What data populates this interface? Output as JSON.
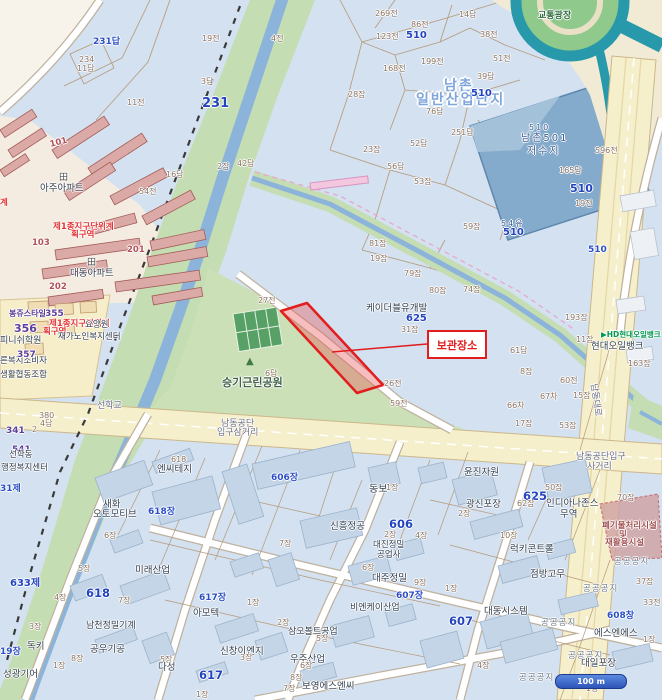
{
  "map": {
    "annotation": {
      "label": "보관장소"
    },
    "scale_bar": {
      "label": "100 m"
    },
    "colors": {
      "parcel_bg": "#d3e1f0",
      "park_green": "#cbe0b6",
      "river_bank": "#c5ddb2",
      "water": "#8cb4da",
      "reservoir": "#85abcc",
      "road_yellow": "#f6efcc",
      "expressway_teal": "#2898ab",
      "highlight_red": "#e21d1d",
      "residential": "#f5ece1",
      "apartment": "#dcaaa6"
    },
    "labels": [
      {
        "t": "231답",
        "x": 93,
        "y": 38,
        "c": "b"
      },
      {
        "t": "234",
        "x": 79,
        "y": 56,
        "c": "p"
      },
      {
        "t": "11답",
        "x": 77,
        "y": 65,
        "c": "p"
      },
      {
        "t": "19전",
        "x": 202,
        "y": 35,
        "c": "p"
      },
      {
        "t": "3답",
        "x": 201,
        "y": 78,
        "c": "p"
      },
      {
        "t": "231",
        "x": 202,
        "y": 97,
        "c": "B",
        "fs": 13
      },
      {
        "t": "11전",
        "x": 127,
        "y": 99,
        "c": "p"
      },
      {
        "t": "4전",
        "x": 271,
        "y": 35,
        "c": "p"
      },
      {
        "t": "42답",
        "x": 237,
        "y": 160,
        "c": "p"
      },
      {
        "t": "16답",
        "x": 166,
        "y": 171,
        "c": "p"
      },
      {
        "t": "54전",
        "x": 139,
        "y": 188,
        "c": "p"
      },
      {
        "t": "2잡",
        "x": 217,
        "y": 163,
        "c": "p"
      },
      {
        "t": "269전",
        "x": 375,
        "y": 10,
        "c": "p"
      },
      {
        "t": "86전",
        "x": 411,
        "y": 21,
        "c": "p"
      },
      {
        "t": "123전",
        "x": 376,
        "y": 33,
        "c": "p"
      },
      {
        "t": "510",
        "x": 406,
        "y": 31,
        "c": "B",
        "fs": 10
      },
      {
        "t": "14답",
        "x": 459,
        "y": 11,
        "c": "p"
      },
      {
        "t": "38전",
        "x": 480,
        "y": 31,
        "c": "p"
      },
      {
        "t": "199전",
        "x": 421,
        "y": 58,
        "c": "p"
      },
      {
        "t": "51전",
        "x": 493,
        "y": 55,
        "c": "p"
      },
      {
        "t": "168전",
        "x": 383,
        "y": 65,
        "c": "p"
      },
      {
        "t": "39답",
        "x": 477,
        "y": 73,
        "c": "p"
      },
      {
        "t": "28잡",
        "x": 348,
        "y": 91,
        "c": "p"
      },
      {
        "t": "남촌",
        "x": 444,
        "y": 79,
        "c": "G"
      },
      {
        "t": "일반산업단지",
        "x": 416,
        "y": 93,
        "c": "G"
      },
      {
        "t": "510",
        "x": 471,
        "y": 89,
        "c": "B",
        "fs": 10
      },
      {
        "t": "76답",
        "x": 426,
        "y": 108,
        "c": "p"
      },
      {
        "t": "52답",
        "x": 410,
        "y": 140,
        "c": "p"
      },
      {
        "t": "23잡",
        "x": 363,
        "y": 146,
        "c": "p"
      },
      {
        "t": "56답",
        "x": 387,
        "y": 163,
        "c": "p"
      },
      {
        "t": "53잡",
        "x": 414,
        "y": 178,
        "c": "p"
      },
      {
        "t": "251답",
        "x": 451,
        "y": 129,
        "c": "p"
      },
      {
        "t": "81잡",
        "x": 369,
        "y": 240,
        "c": "p"
      },
      {
        "t": "19잡",
        "x": 370,
        "y": 255,
        "c": "p"
      },
      {
        "t": "59잡",
        "x": 463,
        "y": 223,
        "c": "p"
      },
      {
        "t": "79잡",
        "x": 404,
        "y": 270,
        "c": "p"
      },
      {
        "t": "80잡",
        "x": 429,
        "y": 287,
        "c": "p"
      },
      {
        "t": "74잡",
        "x": 463,
        "y": 286,
        "c": "p"
      },
      {
        "t": "27전",
        "x": 258,
        "y": 297,
        "c": "p"
      },
      {
        "t": "교통광장",
        "x": 538,
        "y": 12,
        "c": "e",
        "n": "traffic-plaza-label"
      },
      {
        "t": "510",
        "x": 529,
        "y": 124,
        "c": "R",
        "fs": 8
      },
      {
        "t": "남촌501",
        "x": 521,
        "y": 134,
        "c": "R",
        "n": "reservoir-name"
      },
      {
        "t": "저수지",
        "x": 527,
        "y": 147,
        "c": "R",
        "n": "reservoir-name"
      },
      {
        "t": "54유",
        "x": 501,
        "y": 220,
        "c": "R",
        "fs": 8
      },
      {
        "t": "510",
        "x": 503,
        "y": 228,
        "c": "B",
        "fs": 10
      },
      {
        "t": "596전",
        "x": 595,
        "y": 147,
        "c": "p"
      },
      {
        "t": "165답",
        "x": 559,
        "y": 167,
        "c": "p"
      },
      {
        "t": "510",
        "x": 570,
        "y": 183,
        "c": "B",
        "fs": 11
      },
      {
        "t": "19전",
        "x": 575,
        "y": 200,
        "c": "p"
      },
      {
        "t": "510",
        "x": 588,
        "y": 246,
        "c": "b"
      },
      {
        "t": "193잡",
        "x": 565,
        "y": 314,
        "c": "p"
      },
      {
        "t": "11잡",
        "x": 576,
        "y": 336,
        "c": "p"
      },
      {
        "t": "163잡",
        "x": 628,
        "y": 360,
        "c": "p"
      },
      {
        "t": "60전",
        "x": 560,
        "y": 377,
        "c": "p"
      },
      {
        "t": "15잡",
        "x": 573,
        "y": 392,
        "c": "p"
      },
      {
        "t": "67차",
        "x": 540,
        "y": 393,
        "c": "p"
      },
      {
        "t": "66차",
        "x": 507,
        "y": 402,
        "c": "p"
      },
      {
        "t": "8잡",
        "x": 520,
        "y": 368,
        "c": "p"
      },
      {
        "t": "61답",
        "x": 510,
        "y": 347,
        "c": "p"
      },
      {
        "t": "17잡",
        "x": 515,
        "y": 420,
        "c": "p"
      },
      {
        "t": "53잡",
        "x": 559,
        "y": 422,
        "c": "p"
      },
      {
        "t": "▶HD현대오일뱅크",
        "x": 601,
        "y": 331,
        "c": "h",
        "n": "hd-hyundai-oilbank-logo"
      },
      {
        "t": "현대오일뱅크",
        "x": 591,
        "y": 342,
        "c": "n",
        "n": "hyundai-oilbank-label"
      },
      {
        "t": "남동대로",
        "x": 597,
        "y": 383,
        "c": "g",
        "r": 82,
        "n": "road-name-namdong-daero"
      },
      {
        "t": "케이더블유개발",
        "x": 366,
        "y": 304,
        "c": "n"
      },
      {
        "t": "625",
        "x": 406,
        "y": 314,
        "c": "B",
        "fs": 10
      },
      {
        "t": "31잡",
        "x": 401,
        "y": 326,
        "c": "p"
      },
      {
        "t": "26전",
        "x": 384,
        "y": 380,
        "c": "p"
      },
      {
        "t": "59전",
        "x": 390,
        "y": 400,
        "c": "p"
      },
      {
        "t": "승기근린공원",
        "x": 222,
        "y": 377,
        "c": "k",
        "fs": 11,
        "n": "park-name"
      },
      {
        "t": "6답",
        "x": 265,
        "y": 370,
        "c": "p"
      },
      {
        "t": "▲",
        "x": 246,
        "y": 357,
        "c": "tree",
        "n": "park-icon"
      },
      {
        "t": "선학교",
        "x": 97,
        "y": 402,
        "c": "g",
        "n": "bridge-name"
      },
      {
        "t": "남동공단",
        "x": 221,
        "y": 420,
        "c": "g",
        "n": "junction-name"
      },
      {
        "t": "입구삼거리",
        "x": 217,
        "y": 429,
        "c": "g",
        "n": "junction-name"
      },
      {
        "t": "남동공단입구",
        "x": 576,
        "y": 453,
        "c": "g",
        "n": "junction-name"
      },
      {
        "t": "사거리",
        "x": 587,
        "y": 463,
        "c": "g",
        "n": "junction-name"
      },
      {
        "t": "田",
        "x": 59,
        "y": 174,
        "c": "apt-ic",
        "n": "apartment-icon"
      },
      {
        "t": "아주아파트",
        "x": 40,
        "y": 184,
        "c": "n"
      },
      {
        "t": "田",
        "x": 87,
        "y": 259,
        "c": "apt-ic",
        "n": "apartment-icon"
      },
      {
        "t": "대동아파트",
        "x": 70,
        "y": 269,
        "c": "n"
      },
      {
        "t": "제1종지구단위계",
        "x": 53,
        "y": 223,
        "c": "z"
      },
      {
        "t": "획구역",
        "x": 71,
        "y": 231,
        "c": "z"
      },
      {
        "t": "103",
        "x": 32,
        "y": 239,
        "c": "a"
      },
      {
        "t": "201",
        "x": 127,
        "y": 246,
        "c": "a"
      },
      {
        "t": "202",
        "x": 49,
        "y": 283,
        "c": "a"
      },
      {
        "t": "101",
        "x": 49,
        "y": 141,
        "c": "a",
        "r": -14
      },
      {
        "t": "계",
        "x": 0,
        "y": 199,
        "c": "z"
      },
      {
        "t": "355",
        "x": 45,
        "y": 310,
        "c": "P"
      },
      {
        "t": "봉쥬스타일",
        "x": 9,
        "y": 310,
        "c": "P",
        "fs": 8
      },
      {
        "t": "356",
        "x": 14,
        "y": 323,
        "c": "P",
        "fs": 11
      },
      {
        "t": "피니쉬학원",
        "x": 0,
        "y": 337,
        "c": "n",
        "fs": 9
      },
      {
        "t": "제1종지구단위계",
        "x": 49,
        "y": 320,
        "c": "z"
      },
      {
        "t": "획구역",
        "x": 43,
        "y": 328,
        "c": "z"
      },
      {
        "t": "요양원",
        "x": 85,
        "y": 321,
        "c": "n",
        "fs": 8.5
      },
      {
        "t": "재가노인복지센터",
        "x": 58,
        "y": 333,
        "c": "n",
        "fs": 8.5
      },
      {
        "t": "른복지소비자",
        "x": 0,
        "y": 357,
        "c": "n",
        "fs": 8.5
      },
      {
        "t": "생활협동조합",
        "x": 0,
        "y": 371,
        "c": "n",
        "fs": 8.5
      },
      {
        "t": "357",
        "x": 17,
        "y": 351,
        "c": "P"
      },
      {
        "t": "380",
        "x": 39,
        "y": 412,
        "c": "p"
      },
      {
        "t": "4답",
        "x": 40,
        "y": 420,
        "c": "p"
      },
      {
        "t": "341",
        "x": 6,
        "y": 427,
        "c": "P"
      },
      {
        "t": "2",
        "x": 32,
        "y": 426,
        "c": "p"
      },
      {
        "t": "541",
        "x": 12,
        "y": 446,
        "c": "P"
      },
      {
        "t": "선학동",
        "x": 9,
        "y": 451,
        "c": "n",
        "fs": 8.5
      },
      {
        "t": "행정복지센터",
        "x": 1,
        "y": 464,
        "c": "n",
        "fs": 8.5
      },
      {
        "t": "31제",
        "x": 0,
        "y": 485,
        "c": "b"
      },
      {
        "t": "633제",
        "x": 10,
        "y": 579,
        "c": "B",
        "fs": 10
      },
      {
        "t": "618",
        "x": 171,
        "y": 456,
        "c": "p"
      },
      {
        "t": "엔씨테지",
        "x": 157,
        "y": 465,
        "c": "n"
      },
      {
        "t": "새화",
        "x": 103,
        "y": 500,
        "c": "n"
      },
      {
        "t": "오토모티브",
        "x": 93,
        "y": 510,
        "c": "n"
      },
      {
        "t": "618장",
        "x": 148,
        "y": 508,
        "c": "b"
      },
      {
        "t": "6장",
        "x": 104,
        "y": 532,
        "c": "p"
      },
      {
        "t": "5장",
        "x": 78,
        "y": 565,
        "c": "p"
      },
      {
        "t": "4장",
        "x": 54,
        "y": 594,
        "c": "p"
      },
      {
        "t": "618",
        "x": 86,
        "y": 588,
        "c": "B"
      },
      {
        "t": "7장",
        "x": 118,
        "y": 597,
        "c": "p"
      },
      {
        "t": "미래산업",
        "x": 135,
        "y": 566,
        "c": "n"
      },
      {
        "t": "3장",
        "x": 29,
        "y": 623,
        "c": "p"
      },
      {
        "t": "남천정밀기계",
        "x": 86,
        "y": 622,
        "c": "n",
        "fs": 9
      },
      {
        "t": "독키",
        "x": 27,
        "y": 642,
        "c": "n"
      },
      {
        "t": "공우기공",
        "x": 90,
        "y": 645,
        "c": "n"
      },
      {
        "t": "8장",
        "x": 71,
        "y": 655,
        "c": "p"
      },
      {
        "t": "19장",
        "x": 0,
        "y": 648,
        "c": "b"
      },
      {
        "t": "1장",
        "x": 53,
        "y": 662,
        "c": "p"
      },
      {
        "t": "성광기어",
        "x": 3,
        "y": 670,
        "c": "n"
      },
      {
        "t": "617장",
        "x": 199,
        "y": 594,
        "c": "b"
      },
      {
        "t": "아모텍",
        "x": 193,
        "y": 609,
        "c": "n"
      },
      {
        "t": "1장",
        "x": 247,
        "y": 599,
        "c": "p"
      },
      {
        "t": "2장",
        "x": 277,
        "y": 619,
        "c": "p"
      },
      {
        "t": "삼오볼트공업",
        "x": 288,
        "y": 628,
        "c": "n",
        "fs": 9
      },
      {
        "t": "5장",
        "x": 316,
        "y": 635,
        "c": "p"
      },
      {
        "t": "신창이엔지",
        "x": 220,
        "y": 647,
        "c": "n"
      },
      {
        "t": "3장",
        "x": 240,
        "y": 654,
        "c": "p"
      },
      {
        "t": "5장",
        "x": 160,
        "y": 656,
        "c": "p"
      },
      {
        "t": "다성",
        "x": 158,
        "y": 663,
        "c": "n"
      },
      {
        "t": "617",
        "x": 199,
        "y": 670,
        "c": "B"
      },
      {
        "t": "우주산업",
        "x": 290,
        "y": 655,
        "c": "n"
      },
      {
        "t": "6장",
        "x": 300,
        "y": 662,
        "c": "p"
      },
      {
        "t": "8장",
        "x": 290,
        "y": 674,
        "c": "p"
      },
      {
        "t": "7장",
        "x": 283,
        "y": 685,
        "c": "p"
      },
      {
        "t": "보영에스엔씨",
        "x": 302,
        "y": 682,
        "c": "n"
      },
      {
        "t": "1장",
        "x": 196,
        "y": 691,
        "c": "p"
      },
      {
        "t": "606장",
        "x": 271,
        "y": 474,
        "c": "b"
      },
      {
        "t": "동보",
        "x": 369,
        "y": 485,
        "c": "n",
        "fs": 10
      },
      {
        "t": "1장",
        "x": 386,
        "y": 484,
        "c": "p"
      },
      {
        "t": "신흥정공",
        "x": 330,
        "y": 522,
        "c": "n"
      },
      {
        "t": "606",
        "x": 389,
        "y": 519,
        "c": "B"
      },
      {
        "t": "2장",
        "x": 384,
        "y": 531,
        "c": "p"
      },
      {
        "t": "4장",
        "x": 415,
        "y": 532,
        "c": "p"
      },
      {
        "t": "대진정밀",
        "x": 373,
        "y": 541,
        "c": "n",
        "fs": 8.5
      },
      {
        "t": "공업사",
        "x": 377,
        "y": 551,
        "c": "n",
        "fs": 8.5
      },
      {
        "t": "7장",
        "x": 279,
        "y": 540,
        "c": "p"
      },
      {
        "t": "대주정밀",
        "x": 372,
        "y": 574,
        "c": "n"
      },
      {
        "t": "6장",
        "x": 362,
        "y": 564,
        "c": "p"
      },
      {
        "t": "9장",
        "x": 414,
        "y": 579,
        "c": "p"
      },
      {
        "t": "607장",
        "x": 396,
        "y": 592,
        "c": "b"
      },
      {
        "t": "비엔케이산업",
        "x": 350,
        "y": 604,
        "c": "n",
        "fs": 9
      },
      {
        "t": "1장",
        "x": 445,
        "y": 585,
        "c": "p"
      },
      {
        "t": "607",
        "x": 449,
        "y": 616,
        "c": "B"
      },
      {
        "t": "대동시스템",
        "x": 484,
        "y": 607,
        "c": "n"
      },
      {
        "t": "4장",
        "x": 477,
        "y": 662,
        "c": "p"
      },
      {
        "t": "윤진자원",
        "x": 464,
        "y": 468,
        "c": "n"
      },
      {
        "t": "50잡",
        "x": 545,
        "y": 484,
        "c": "p"
      },
      {
        "t": "625",
        "x": 523,
        "y": 491,
        "c": "B"
      },
      {
        "t": "62잡",
        "x": 517,
        "y": 500,
        "c": "p"
      },
      {
        "t": "광신포장",
        "x": 466,
        "y": 500,
        "c": "n"
      },
      {
        "t": "2장",
        "x": 458,
        "y": 510,
        "c": "p"
      },
      {
        "t": "인디아나존스",
        "x": 546,
        "y": 499,
        "c": "n"
      },
      {
        "t": "무역",
        "x": 560,
        "y": 510,
        "c": "n"
      },
      {
        "t": "10장",
        "x": 500,
        "y": 532,
        "c": "p"
      },
      {
        "t": "럭키콘트롤",
        "x": 510,
        "y": 545,
        "c": "n"
      },
      {
        "t": "점방고무",
        "x": 530,
        "y": 570,
        "c": "n"
      },
      {
        "t": "공공공지",
        "x": 614,
        "y": 558,
        "c": "u"
      },
      {
        "t": "공공공지",
        "x": 583,
        "y": 585,
        "c": "u"
      },
      {
        "t": "공공공지",
        "x": 541,
        "y": 619,
        "c": "u"
      },
      {
        "t": "공공공지",
        "x": 568,
        "y": 652,
        "c": "u"
      },
      {
        "t": "공공공지",
        "x": 519,
        "y": 674,
        "c": "u"
      },
      {
        "t": "70잡",
        "x": 617,
        "y": 494,
        "c": "p"
      },
      {
        "t": "폐기물처리시설",
        "x": 602,
        "y": 522,
        "c": "w"
      },
      {
        "t": "및",
        "x": 619,
        "y": 531,
        "c": "w"
      },
      {
        "t": "재활용시설",
        "x": 605,
        "y": 539,
        "c": "w"
      },
      {
        "t": "37잡",
        "x": 636,
        "y": 578,
        "c": "p"
      },
      {
        "t": "33전",
        "x": 643,
        "y": 599,
        "c": "p"
      },
      {
        "t": "608창",
        "x": 607,
        "y": 612,
        "c": "b"
      },
      {
        "t": "에스엔에스",
        "x": 594,
        "y": 629,
        "c": "n"
      },
      {
        "t": "대일포장",
        "x": 581,
        "y": 659,
        "c": "n"
      },
      {
        "t": "1장",
        "x": 643,
        "y": 636,
        "c": "p"
      },
      {
        "t": "1장",
        "x": 586,
        "y": 685,
        "c": "p"
      }
    ]
  }
}
